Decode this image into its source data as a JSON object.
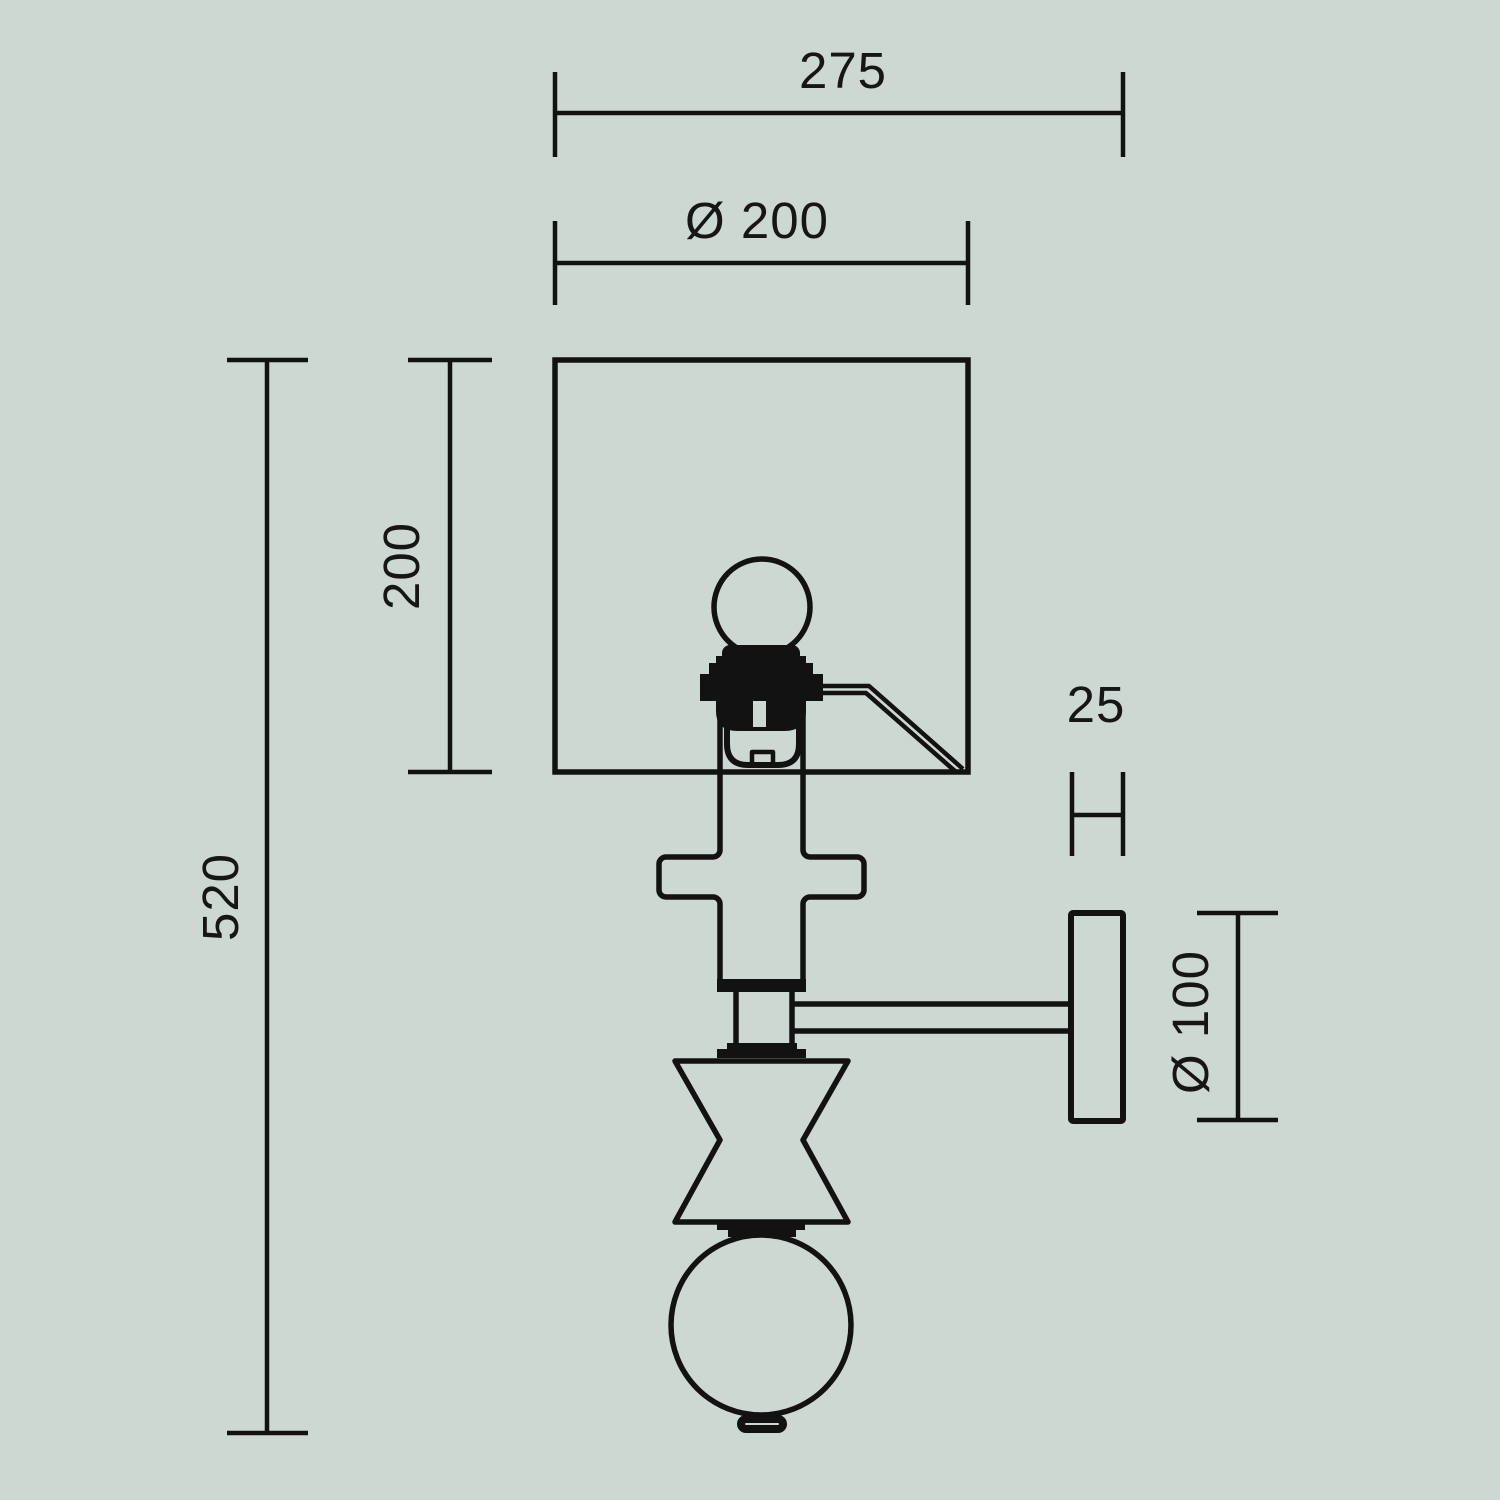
{
  "colors": {
    "background": "#ced8d3",
    "line": "#121212",
    "text": "#161616"
  },
  "drawing": {
    "type": "technical-diagram",
    "subject": "Wall lamp (sconce) side elevation with dimension lines",
    "units": "mm",
    "dimensions": {
      "overall_width": {
        "label": "275",
        "orientation": "horizontal"
      },
      "shade_diameter": {
        "label": "Ø 200",
        "orientation": "horizontal"
      },
      "shade_height": {
        "label": "200",
        "orientation": "vertical"
      },
      "overall_height": {
        "label": "520",
        "orientation": "vertical"
      },
      "plate_thickness": {
        "label": "25",
        "orientation": "horizontal"
      },
      "plate_diameter": {
        "label": "Ø 100",
        "orientation": "vertical"
      }
    },
    "parts": [
      "square lamp shade",
      "light bulb",
      "lamp socket",
      "shade support arm",
      "stem cross element",
      "stem cylinder",
      "stem hourglass element",
      "sphere finial",
      "end cap",
      "wall mount arm",
      "wall plate"
    ]
  }
}
